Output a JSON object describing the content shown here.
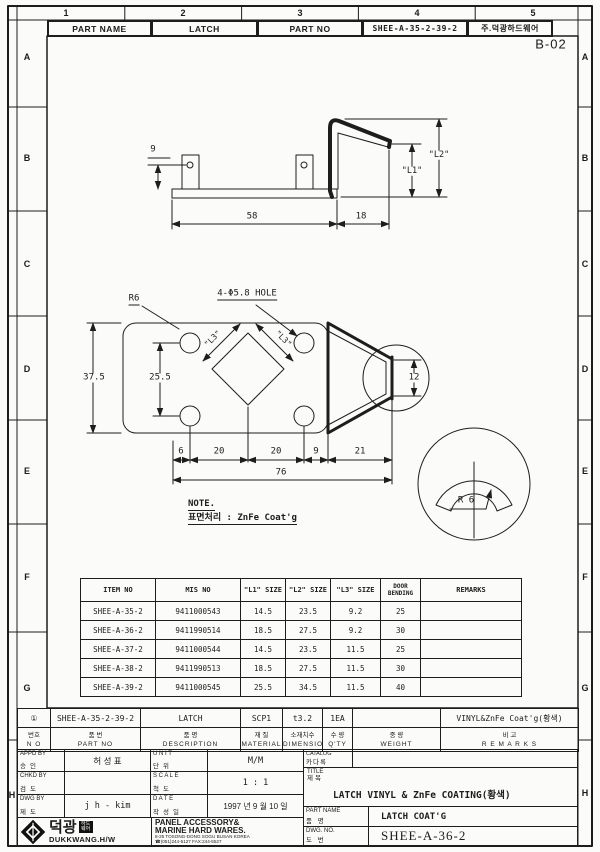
{
  "frame": {
    "zones": [
      "A",
      "B",
      "C",
      "D",
      "E",
      "F",
      "G",
      "H"
    ],
    "cols": [
      "1",
      "2",
      "3",
      "4",
      "5"
    ],
    "code": "B-02"
  },
  "top_header": {
    "part_name_label": "PART NAME",
    "part_name_value": "LATCH",
    "part_no_label": "PART NO",
    "part_no_value": "SHEE-A-35-2-39-2",
    "company": "주.덕광하드웨어"
  },
  "side_view": {
    "d9": "9",
    "d58": "58",
    "d18": "18",
    "l1": "\"L1\"",
    "l2": "\"L2\""
  },
  "plan_view": {
    "r6": "R6",
    "hole_label": "4-Φ5.8 HOLE",
    "l3_left": "\"L3\"",
    "l3_right": "\"L3\"",
    "d375": "37.5",
    "d255": "25.5",
    "d12": "12",
    "c6": "6",
    "c20a": "20",
    "c20b": "20",
    "c9": "9",
    "c21": "21",
    "c76": "76"
  },
  "detail_view": {
    "r6": "R 6"
  },
  "note": {
    "title": "NOTE.",
    "body": "표면처리 : ZnFe Coat'g"
  },
  "item_table": {
    "headers": [
      "ITEM  NO",
      "MIS  NO",
      "\"L1\" SIZE",
      "\"L2\" SIZE",
      "\"L3\" SIZE",
      "DOOR BENDING",
      "REMARKS"
    ],
    "rows": [
      {
        "item_no": "SHEE-A-35-2",
        "mis_no": "9411000543",
        "l1": "14.5",
        "l2": "23.5",
        "l3": "9.2",
        "door": "25",
        "remarks": ""
      },
      {
        "item_no": "SHEE-A-36-2",
        "mis_no": "9411990514",
        "l1": "18.5",
        "l2": "27.5",
        "l3": "9.2",
        "door": "30",
        "remarks": ""
      },
      {
        "item_no": "SHEE-A-37-2",
        "mis_no": "9411000544",
        "l1": "14.5",
        "l2": "23.5",
        "l3": "11.5",
        "door": "25",
        "remarks": ""
      },
      {
        "item_no": "SHEE-A-38-2",
        "mis_no": "9411990513",
        "l1": "18.5",
        "l2": "27.5",
        "l3": "11.5",
        "door": "30",
        "remarks": ""
      },
      {
        "item_no": "SHEE-A-39-2",
        "mis_no": "9411000545",
        "l1": "25.5",
        "l2": "34.5",
        "l3": "11.5",
        "door": "40",
        "remarks": ""
      }
    ]
  },
  "parts_list": {
    "row": {
      "no": "①",
      "part_no": "SHEE-A-35-2-39-2",
      "description": "LATCH",
      "material": "SCP1",
      "dimension": "t3.2",
      "qty": "1EA",
      "weight": "",
      "remarks": "VINYL&ZnFe Coat'g(황색)"
    },
    "headers": {
      "no_kr": "번호",
      "no_en": "N O",
      "part_kr": "품   번",
      "part_en": "PART   NO",
      "desc_kr": "품   명",
      "desc_en": "DESCRIPTION",
      "mat_kr": "재  질",
      "mat_en": "MATERIAL",
      "dim_kr": "소재치수",
      "dim_en": "DIMENSION",
      "qty_kr": "수 량",
      "qty_en": "Q'TY",
      "wt_kr": "중  량",
      "wt_en": "WEIGHT",
      "rem_kr": "비   고",
      "rem_en": "R E M A R K S"
    }
  },
  "title_block": {
    "appd_en": "APPD BY",
    "appd_kr": "승인",
    "appd_value": "허  성  표",
    "chkd_en": "CHKD BY",
    "chkd_kr": "검도",
    "chkd_value": "",
    "dwgby_en": "DWG  BY",
    "dwgby_kr": "제도",
    "dwgby_value": "j h - kim",
    "unit_en": "U N I T",
    "unit_kr": "단위",
    "unit_value": "M/M",
    "scale_en": "S C A L E",
    "scale_kr": "척도",
    "scale_value": "1 : 1",
    "date_en": "D A T E",
    "date_kr": "작성일",
    "date_value": "1997 년 9 월 10 일",
    "catalog_en": "CATALOG",
    "catalog_kr": "카다록",
    "catalog_value": "",
    "title_en": "TITLE",
    "title_kr": "제목",
    "title_value": "LATCH VINYL & ZnFe COATING(황색)",
    "pn_en": "PART  NAME",
    "pn_kr": "품    명",
    "pn_value": "LATCH COAT'G",
    "dn_en": "DWG.    NO.",
    "dn_kr": "도    번",
    "dn_value": "SHEE-A-36-2",
    "company": {
      "logo_kr": "덕광",
      "logo_badge": "하드웨어",
      "logo_sub": "DUKKWANG.H/W",
      "line1": "PANEL ACCESSORY&",
      "line2": "MARINE HARD WARES.",
      "line3": "8-25 TOSONG-DONG SOGU BUSAN KOREA",
      "line4": "☎(051)244-5127 FAX:244-5527"
    }
  }
}
